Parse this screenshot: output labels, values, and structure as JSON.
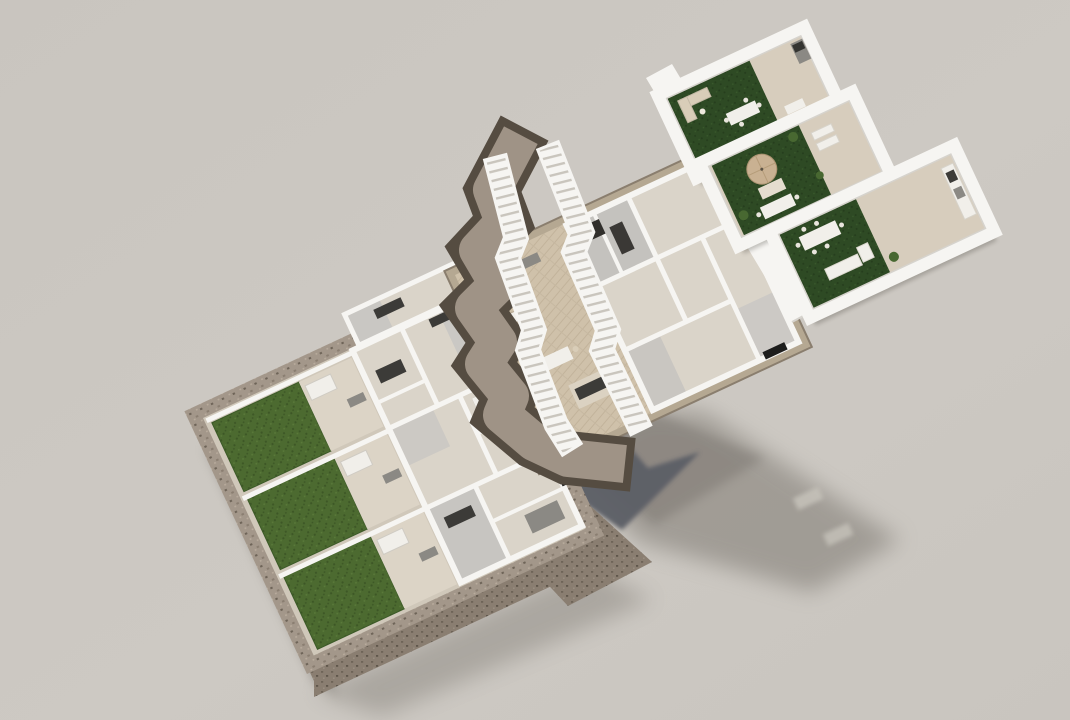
{
  "scene": {
    "title": "Exploded 3D floor-plan render of a three-level residential building",
    "description": "Architectural visualization with three separated levels: a ground floor with three private gardens inside a stone perimeter wall, a first floor with twin zigzag staircases along a cut terrain edge and open-plan living areas, and three stepped roof terraces with artificial turf, outdoor dining sets, sun loungers, a parasol and outdoor kitchens. Soft shadows fall on a neutral studio backdrop.",
    "type": "architectural-3d-floor-plan-exploded-view",
    "floors": [
      {
        "name": "ground-floor",
        "label": "Ground floor",
        "features": [
          "three private gardens",
          "stone perimeter wall",
          "patios with pergolas",
          "bedrooms",
          "kitchen and dining rooms"
        ]
      },
      {
        "name": "first-floor",
        "label": "First floor",
        "features": [
          "twin zigzag staircases",
          "rock terrain edge",
          "open-plan living and dining",
          "kitchen islands",
          "bedrooms and bathrooms"
        ]
      },
      {
        "name": "roof-terraces",
        "label": "Roof terraces",
        "features": [
          "three stepped terraces",
          "artificial turf decks",
          "outdoor dining tables",
          "sun loungers",
          "parasol",
          "outdoor kitchen units"
        ]
      }
    ],
    "environment": {
      "ground": "neutral warm-grey backdrop",
      "shadow": "large soft cast shadow toward lower right with two bright window slits"
    }
  },
  "colors": {
    "bg": "#c9c5bf",
    "bgLight": "#cdc9c3",
    "wall": "#f6f5f2",
    "wallShade": "#d6d3cd",
    "floorGround": "#d0c8ba",
    "floorRoom": "#dad4c9",
    "floorWood": "#cfc1aa",
    "patio": "#dcd4c6",
    "deck": "#d7cdbd",
    "grass": "#4c6a30",
    "grassDark": "#3d5726",
    "turf": "#2e4a24",
    "turfDark": "#253d1d",
    "stone": "#a3978a",
    "stoneDark": "#8a7e71",
    "stoneDarker": "#6e6458",
    "rim": "#554c41",
    "terrain": "#9f9386",
    "slabEdge": "#b5a892",
    "slate": "#5b5e66",
    "shadow": "#7e7972",
    "furnDark": "#3c3b38",
    "furnGray": "#8b8984",
    "furnLight": "#f1efea",
    "furnBeige": "#d9cdb8",
    "windowDark": "#1d1d1c",
    "plant": "#486831",
    "parasol": "#c9b192",
    "tread": "#c9c5bd"
  }
}
